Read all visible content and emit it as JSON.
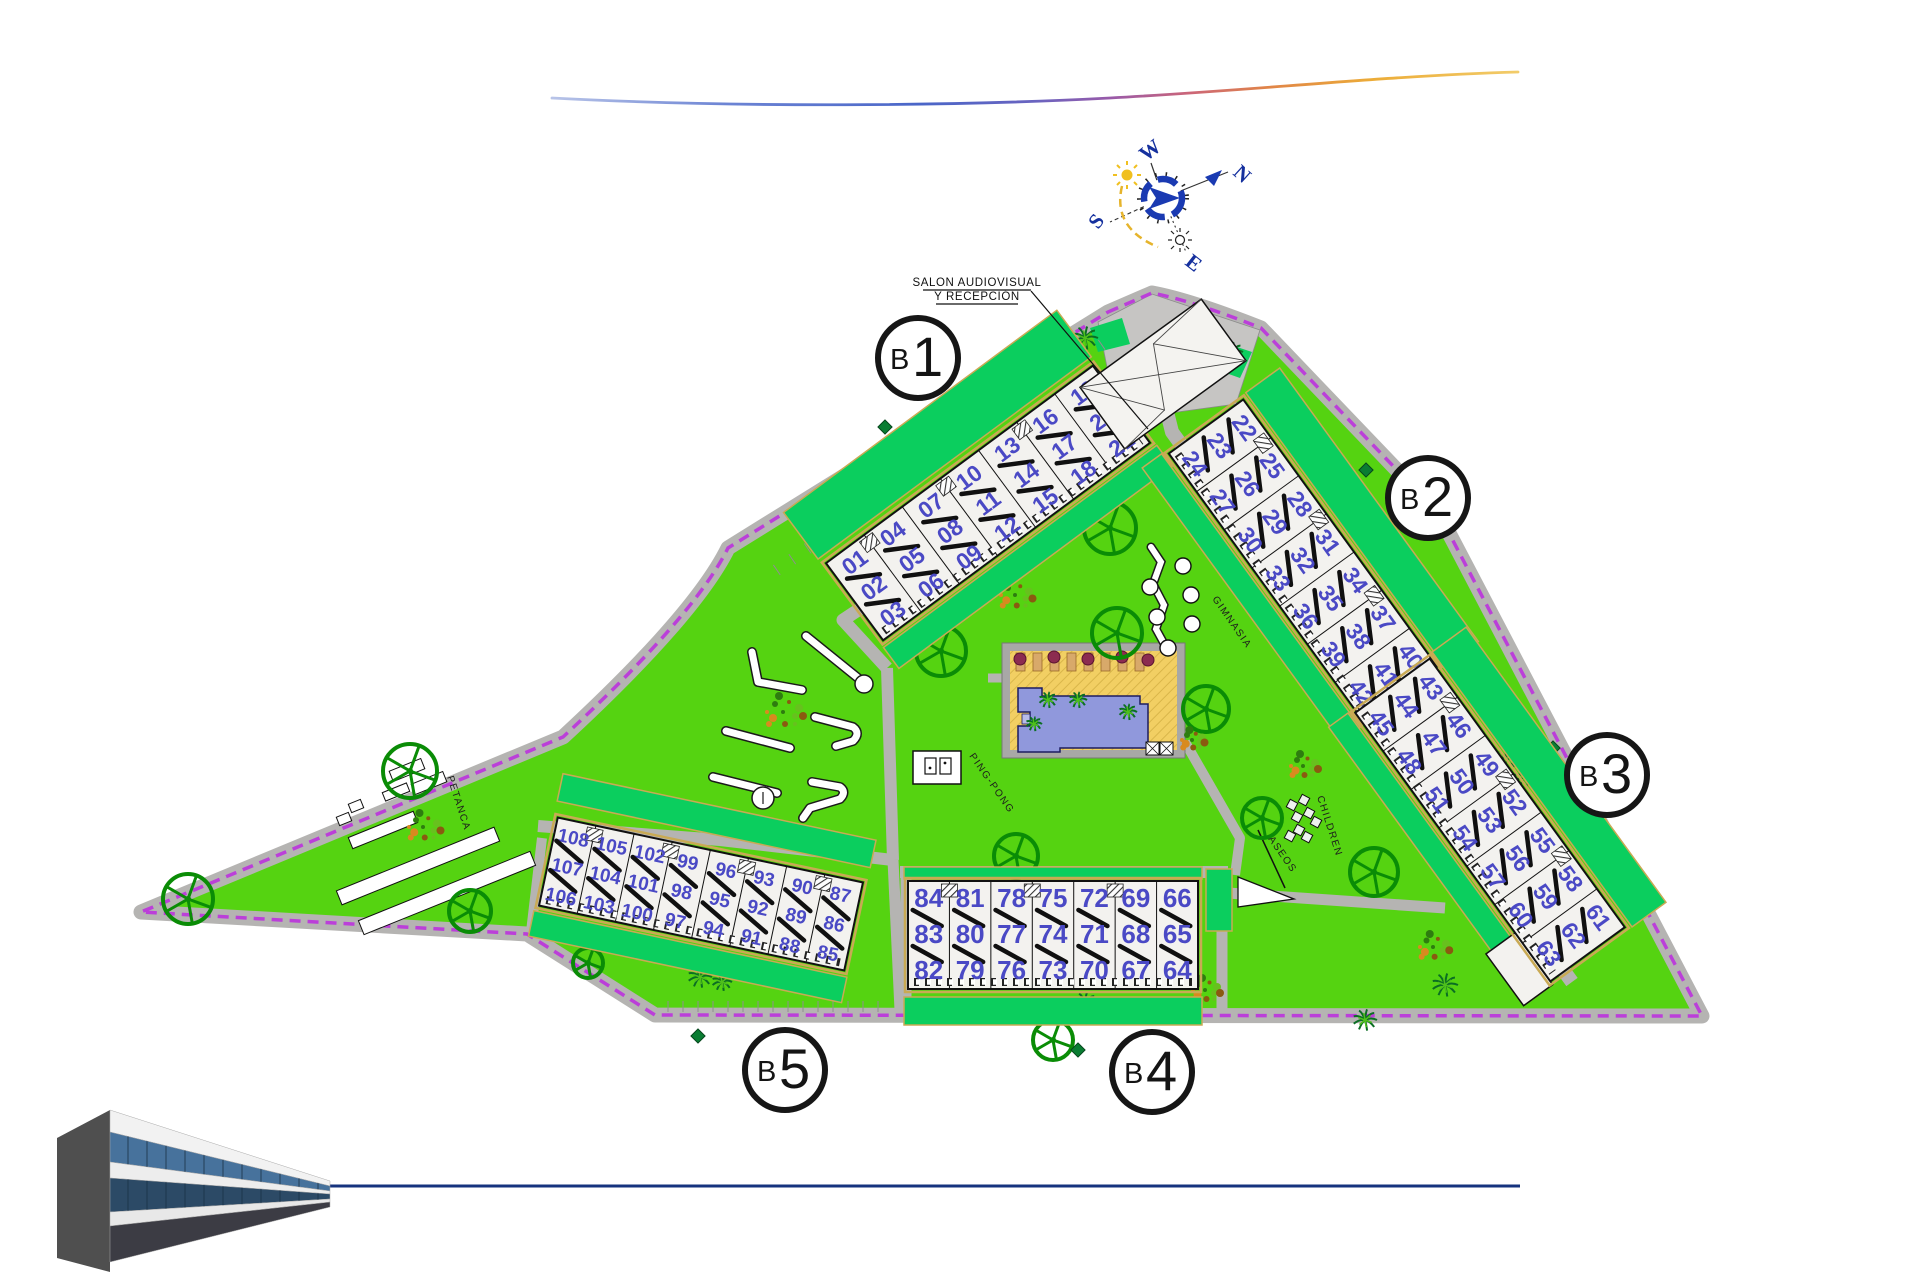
{
  "annotations": {
    "reception_line1": "SALON AUDIOVISUAL",
    "reception_line2": "Y RECEPCIÓN",
    "petanca": "PETANCA",
    "ping_pong": "PING-PONG",
    "gimnasia": "GIMNASIA",
    "children": "CHILDREN",
    "aseos": "ASEOS"
  },
  "compass": {
    "n": "N",
    "s": "S",
    "e": "E",
    "w": "W"
  },
  "blocks": {
    "b1": {
      "circle_prefix": "B",
      "circle_number": "1",
      "units": [
        [
          "01",
          "02",
          "03"
        ],
        [
          "04",
          "05",
          "06"
        ],
        [
          "07",
          "08",
          "09"
        ],
        [
          "10",
          "11",
          "12"
        ],
        [
          "13",
          "14",
          "15"
        ],
        [
          "16",
          "17",
          "18"
        ],
        [
          "19",
          "20",
          "21"
        ]
      ]
    },
    "b2": {
      "circle_prefix": "B",
      "circle_number": "2",
      "units": [
        [
          "22",
          "23",
          "24"
        ],
        [
          "25",
          "26",
          "27"
        ],
        [
          "28",
          "29",
          "30"
        ],
        [
          "31",
          "32",
          "33"
        ],
        [
          "34",
          "35",
          "36"
        ],
        [
          "37",
          "38",
          "39"
        ],
        [
          "40",
          "41",
          "42"
        ]
      ]
    },
    "b3": {
      "circle_prefix": "B",
      "circle_number": "3",
      "units": [
        [
          "43",
          "44",
          "45"
        ],
        [
          "46",
          "47",
          "48"
        ],
        [
          "49",
          "50",
          "51"
        ],
        [
          "52",
          "53",
          "54"
        ],
        [
          "55",
          "56",
          "57"
        ],
        [
          "58",
          "59",
          "60"
        ],
        [
          "61",
          "62",
          "63"
        ]
      ]
    },
    "b4": {
      "circle_prefix": "B",
      "circle_number": "4",
      "units": [
        [
          "84",
          "83",
          "82"
        ],
        [
          "81",
          "80",
          "79"
        ],
        [
          "78",
          "77",
          "76"
        ],
        [
          "75",
          "74",
          "73"
        ],
        [
          "72",
          "71",
          "70"
        ],
        [
          "69",
          "68",
          "67"
        ],
        [
          "66",
          "65",
          "64"
        ]
      ]
    },
    "b5": {
      "circle_prefix": "B",
      "circle_number": "5",
      "units": [
        [
          "108",
          "107",
          "106"
        ],
        [
          "105",
          "104",
          "103"
        ],
        [
          "102",
          "101",
          "100"
        ],
        [
          "99",
          "98",
          "97"
        ],
        [
          "96",
          "95",
          "94"
        ],
        [
          "93",
          "92",
          "91"
        ],
        [
          "90",
          "89",
          "88"
        ],
        [
          "87",
          "86",
          "85"
        ]
      ]
    }
  },
  "colors": {
    "lawn": "#55d311",
    "garden": "#0bce5e",
    "road": "#b5b4b2",
    "plaza": "#c6c5c3",
    "boundary": "#bb3fd9",
    "unit_number": "#4a49c5",
    "pool_water": "#9098dc",
    "pool_deck": "#f2cf63",
    "accent_tan": "#c9aa54",
    "bottom_line": "#16337e",
    "compass_blue": "#1a3ab2",
    "sun_yellow": "#f0c020",
    "tree_green": "#0a8c06",
    "palm_green": "#0b6e23",
    "umbrella": "#8c2c50"
  }
}
